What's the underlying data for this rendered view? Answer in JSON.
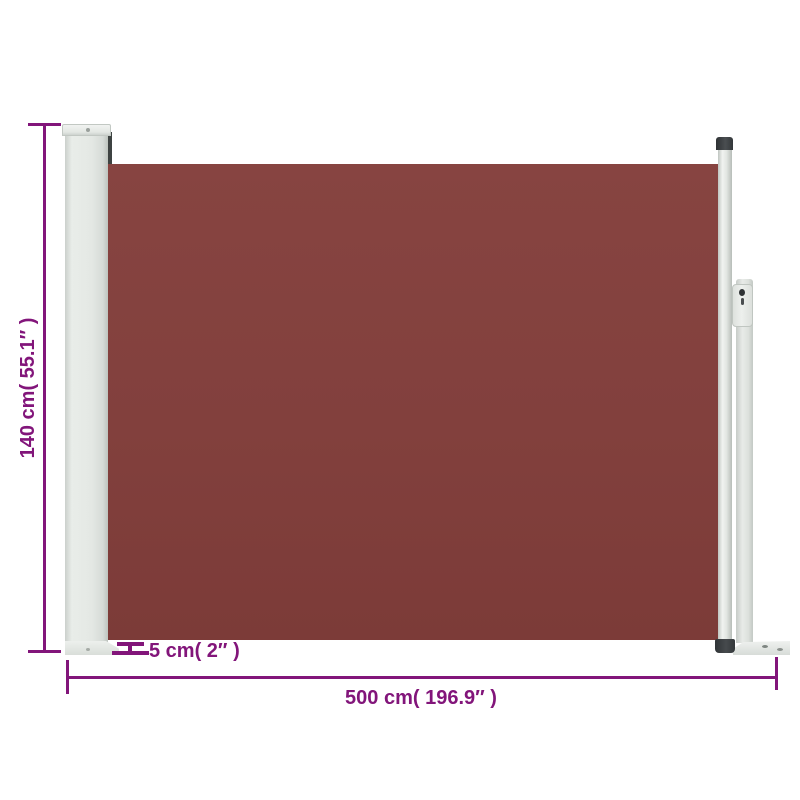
{
  "diagram": {
    "labels": {
      "height": "140 cm( 55.1″ )",
      "depth": "5 cm( 2″ )",
      "width": "500 cm( 196.9″ )"
    },
    "colors": {
      "dimension_purple": "#82157A",
      "fabric_brown": "#82403D",
      "frame_light_gray": "#E4E8E4",
      "cap_dark_gray": "#3B3F42",
      "background": "#FFFFFF"
    }
  }
}
